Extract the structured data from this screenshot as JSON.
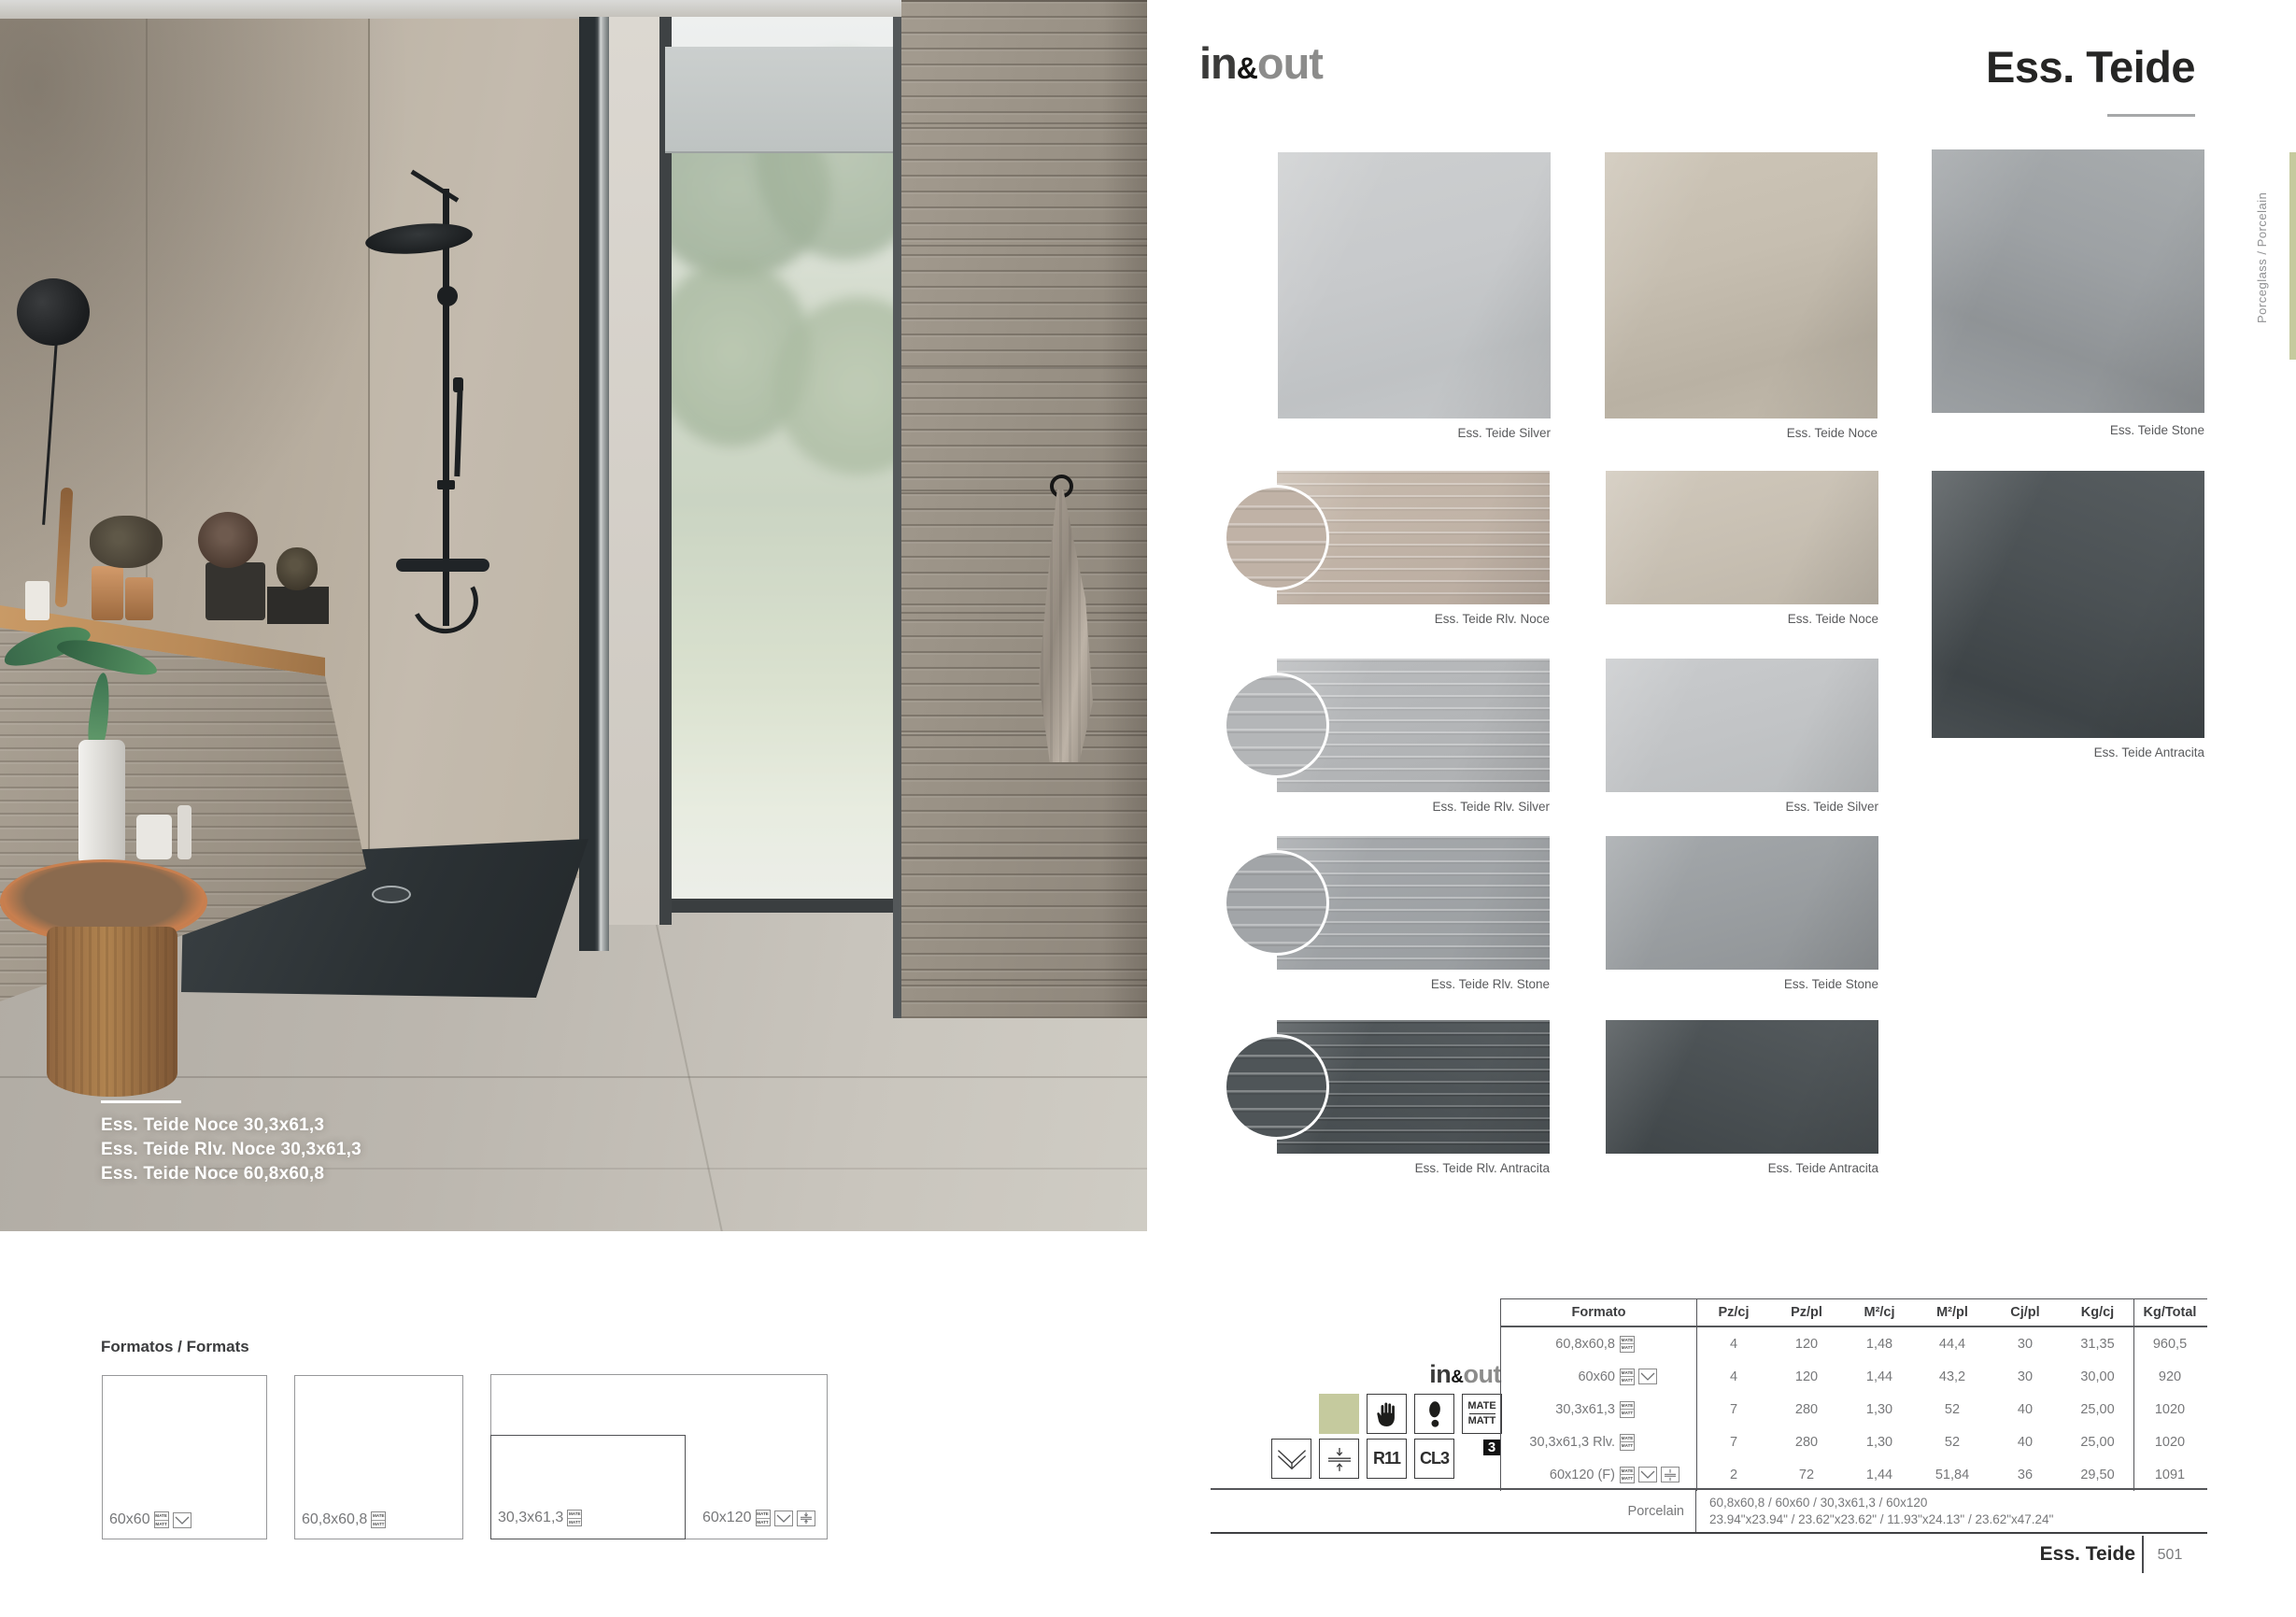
{
  "header": {
    "logo_in": "in",
    "logo_amp": "&",
    "logo_out": "out",
    "title": "Ess. Teide"
  },
  "side": {
    "label": "Porceglass / Porcelain",
    "accent_color": "#c5ca9e"
  },
  "photo": {
    "caption_lines": [
      "Ess. Teide Noce 30,3x61,3",
      "Ess. Teide Rlv. Noce 30,3x61,3",
      "Ess. Teide Noce 60,8x60,8"
    ]
  },
  "swatches": [
    {
      "label": "Ess. Teide Silver"
    },
    {
      "label": "Ess. Teide Noce"
    },
    {
      "label": "Ess. Teide Stone"
    },
    {
      "label": "Ess. Teide Rlv. Noce"
    },
    {
      "label": "Ess. Teide Noce"
    },
    {
      "label": "Ess. Teide Antracita"
    },
    {
      "label": "Ess. Teide Rlv. Silver"
    },
    {
      "label": "Ess. Teide Silver"
    },
    {
      "label": "Ess. Teide Rlv. Stone"
    },
    {
      "label": "Ess. Teide Stone"
    },
    {
      "label": "Ess. Teide Rlv. Antracita"
    },
    {
      "label": "Ess. Teide Antracita"
    }
  ],
  "formats": {
    "heading": "Formatos / Formats",
    "items": [
      {
        "label": "60x60",
        "icons": [
          "matte",
          "shade-variation"
        ]
      },
      {
        "label": "60,8x60,8",
        "icons": [
          "matte"
        ]
      },
      {
        "label": "30,3x61,3",
        "icons": [
          "matte"
        ]
      },
      {
        "label": "60x120",
        "icons": [
          "matte",
          "shade-variation",
          "rectified"
        ]
      }
    ]
  },
  "legend": {
    "brand_in": "in",
    "brand_amp": "&",
    "brand_out": "out",
    "mate": "MATE",
    "matt": "MATT",
    "r11": "R11",
    "cl3": "CL3",
    "thickness": "3",
    "icons": [
      "color-swatch",
      "hand",
      "footprint",
      "mate-matt",
      "wall-floor",
      "rectified",
      "R11",
      "CL3",
      "thickness-3"
    ]
  },
  "table": {
    "headers": [
      "Formato",
      "Pz/cj",
      "Pz/pl",
      "M²/cj",
      "M²/pl",
      "Cj/pl",
      "Kg/cj",
      "Kg/Total"
    ],
    "rows": [
      {
        "formato": "60,8x60,8",
        "icons": [
          "matte"
        ],
        "values": [
          "4",
          "120",
          "1,48",
          "44,4",
          "30",
          "31,35",
          "960,5"
        ]
      },
      {
        "formato": "60x60",
        "icons": [
          "matte",
          "shade-variation"
        ],
        "values": [
          "4",
          "120",
          "1,44",
          "43,2",
          "30",
          "30,00",
          "920"
        ]
      },
      {
        "formato": "30,3x61,3",
        "icons": [
          "matte"
        ],
        "values": [
          "7",
          "280",
          "1,30",
          "52",
          "40",
          "25,00",
          "1020"
        ]
      },
      {
        "formato": "30,3x61,3 Rlv.",
        "icons": [
          "matte"
        ],
        "values": [
          "7",
          "280",
          "1,30",
          "52",
          "40",
          "25,00",
          "1020"
        ]
      },
      {
        "formato": "60x120 (F)",
        "icons": [
          "matte",
          "shade-variation",
          "rectified"
        ],
        "values": [
          "2",
          "72",
          "1,44",
          "51,84",
          "36",
          "29,50",
          "1091"
        ]
      }
    ],
    "material_row": {
      "label": "Porcelain",
      "sizes_cm": "60,8x60,8 / 60x60 / 30,3x61,3 / 60x120",
      "sizes_in": "23.94\"x23.94\" / 23.62\"x23.62\" / 11.93\"x24.13\" / 23.62\"x47.24\""
    }
  },
  "footer": {
    "collection": "Ess. Teide",
    "page_number": "501"
  }
}
